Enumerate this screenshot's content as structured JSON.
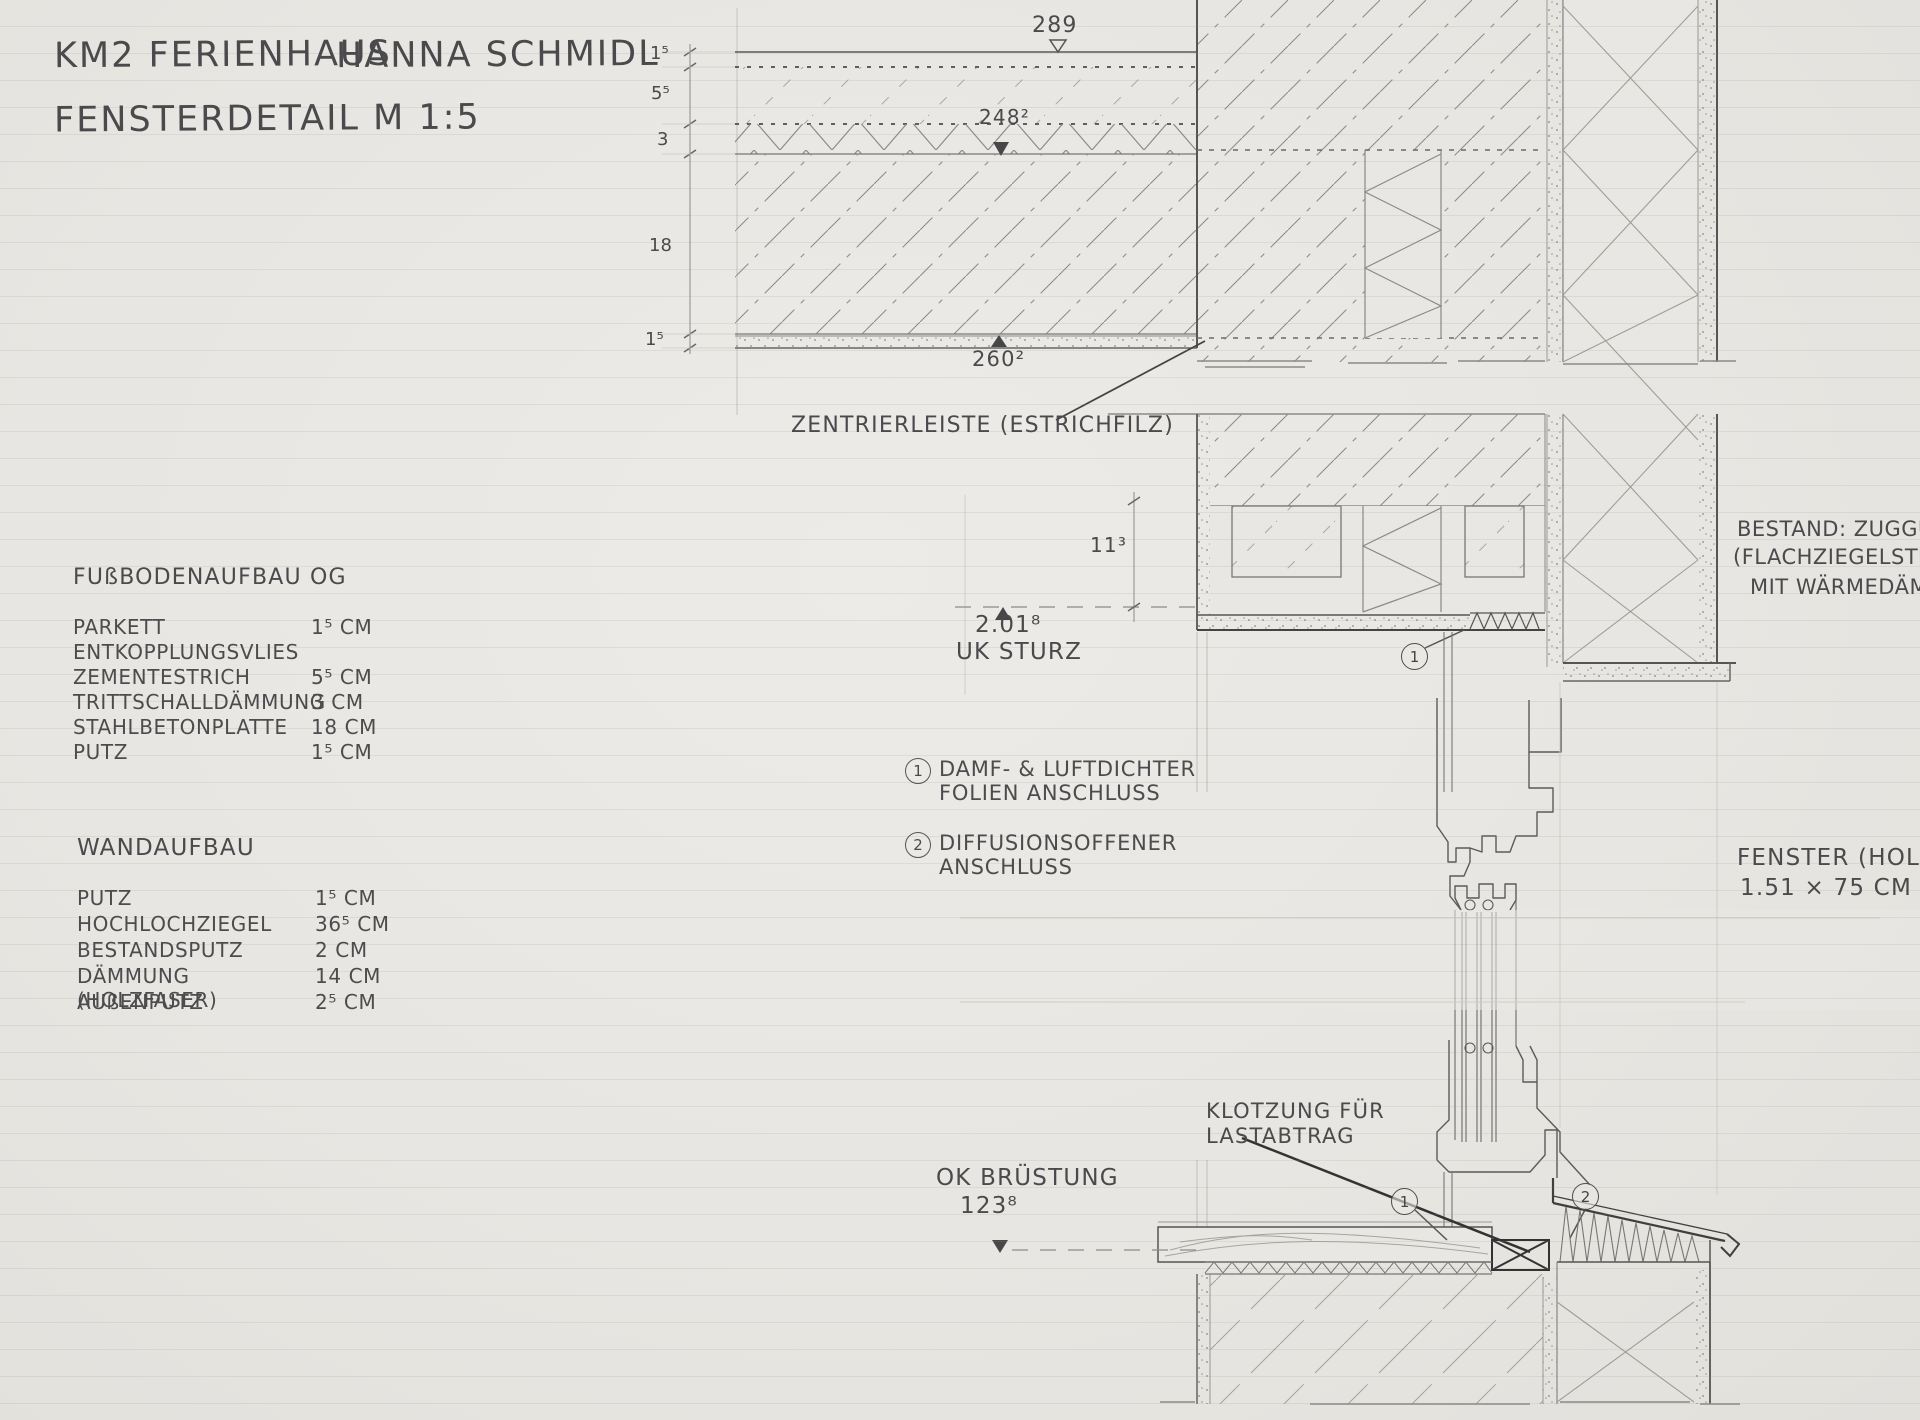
{
  "header": {
    "project": "KM2 FERIENHAUS",
    "author": "HANNA SCHMIDL",
    "subtitle": "FENSTERDETAIL M 1:5"
  },
  "floor_table": {
    "heading": "FUßBODENAUFBAU OG",
    "rows": [
      {
        "label": "PARKETT",
        "value": "1⁵ CM"
      },
      {
        "label": "ENTKOPPLUNGSVLIES",
        "value": ""
      },
      {
        "label": "ZEMENTESTRICH",
        "value": "5⁵ CM"
      },
      {
        "label": "TRITTSCHALLDÄMMUNG",
        "value": "3 CM"
      },
      {
        "label": "STAHLBETONPLATTE",
        "value": "18 CM"
      },
      {
        "label": "PUTZ",
        "value": "1⁵ CM"
      }
    ]
  },
  "wall_table": {
    "heading": "WANDAUFBAU",
    "rows": [
      {
        "label": "PUTZ",
        "value": "1⁵ CM"
      },
      {
        "label": "HOCHLOCHZIEGEL",
        "value": "36⁵ CM"
      },
      {
        "label": "BESTANDSPUTZ",
        "value": "2 CM"
      },
      {
        "label": "DÄMMUNG (HOLZFASER)",
        "value": "14 CM"
      },
      {
        "label": "AUßENPUTZ",
        "value": "2⁵ CM"
      }
    ]
  },
  "notes": [
    {
      "num": "1",
      "line1": "DAMF- & LUFTDICHTER",
      "line2": "FOLIEN ANSCHLUSS"
    },
    {
      "num": "2",
      "line1": "DIFFUSIONSOFFENER",
      "line2": "ANSCHLUSS"
    }
  ],
  "annotations": {
    "zentrierleiste": "ZENTRIERLEISTE (ESTRICHFILZ)",
    "klotzung_line1": "KLOTZUNG FÜR",
    "klotzung_line2": "LASTABTRAG",
    "bestand_line1": "BESTAND: ZUGGURTE",
    "bestand_line2": "(FLACHZIEGELSTÜRZE)",
    "bestand_line3": "MIT WÄRMEDÄMM",
    "fenster_line1": "FENSTER (HOLZ)",
    "fenster_line2": "1.51 × 75 CM"
  },
  "levels": {
    "top_of_floor": "289",
    "top_of_slab": "248²",
    "underside_ceiling": "260²",
    "uk_sturz_value": "2.01⁸",
    "uk_sturz_label": "UK STURZ",
    "dim_11_3": "11³",
    "ok_bruestung_label": "OK BRÜSTUNG",
    "ok_bruestung_value": "123⁸"
  },
  "dim_chain": [
    "1⁵",
    "5⁵",
    "3",
    "18",
    "1⁵"
  ],
  "callouts": {
    "c1": "1",
    "c2": "2"
  },
  "colors": {
    "paper": "#e9e7e3",
    "pencil_dark": "#4f4f51",
    "pencil_mid": "#8d8b87",
    "pencil_faint": "#c4c1bb"
  }
}
